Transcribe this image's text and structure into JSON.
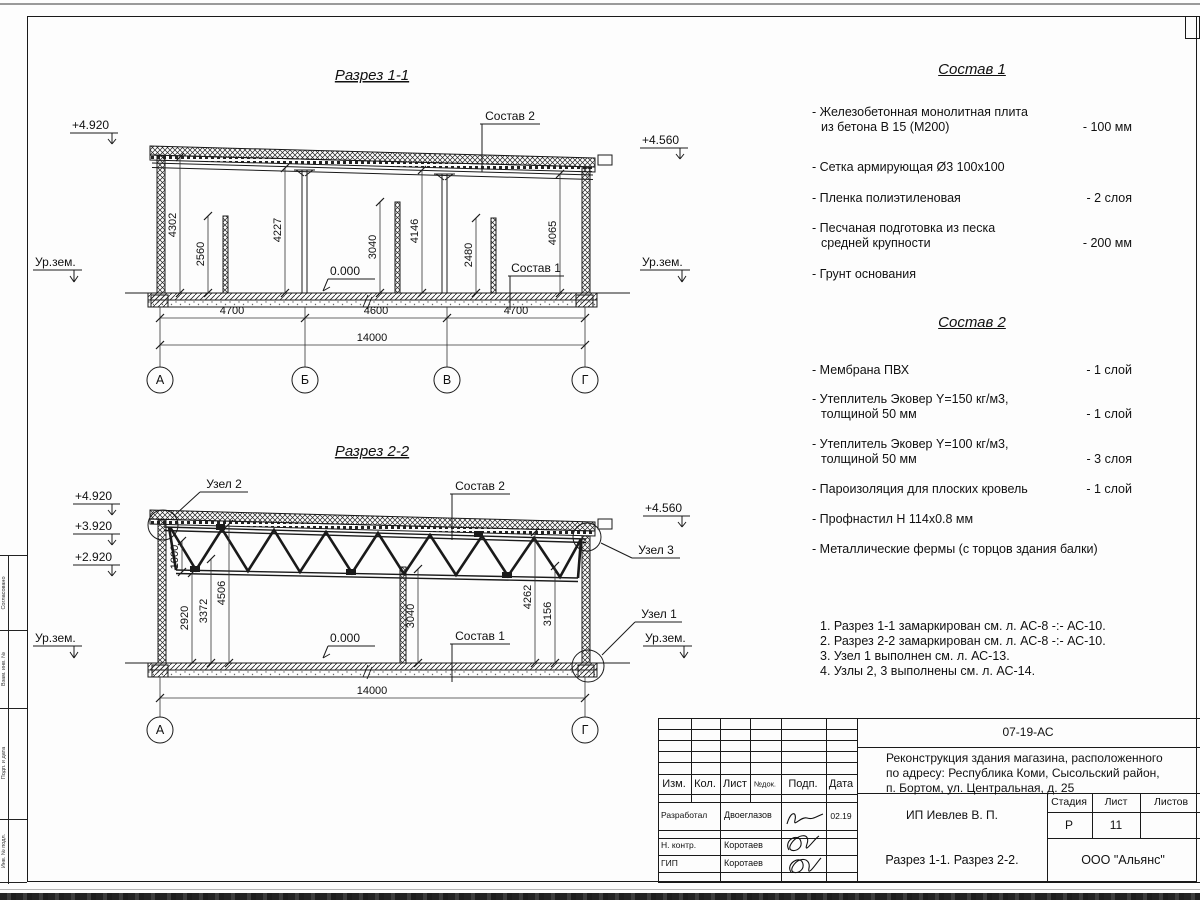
{
  "section1": {
    "title": "Разрез 1-1",
    "elev_left": "+4.920",
    "elev_right": "+4.560",
    "ground_left": "Ур.зем.",
    "ground_right": "Ур.зем.",
    "zero_label": "0.000",
    "label_sostav2": "Состав 2",
    "label_sostav1": "Состав 1",
    "dim_heights": [
      "4302",
      "2560",
      "4227",
      "3040",
      "4146",
      "2480",
      "4065"
    ],
    "dim_spans": [
      "4700",
      "4600",
      "4700"
    ],
    "dim_total": "14000",
    "axes": [
      "А",
      "Б",
      "В",
      "Г"
    ]
  },
  "section2": {
    "title": "Разрез 2-2",
    "elev_levels": [
      "+4.920",
      "+3.920",
      "+2.920"
    ],
    "elev_right": "+4.560",
    "ground_left": "Ур.зем.",
    "ground_right": "Ур.зем.",
    "zero_label": "0.000",
    "label_sostav2": "Состав 2",
    "label_sostav1": "Состав 1",
    "node2": "Узел 2",
    "node3": "Узел 3",
    "node1": "Узел 1",
    "dim_heights": [
      "1000",
      "2920",
      "3372",
      "4506",
      "3040",
      "4262",
      "3156"
    ],
    "dim_total": "14000",
    "axes": [
      "А",
      "Г"
    ]
  },
  "sostav1": {
    "title": "Состав 1",
    "items": [
      {
        "line1": "- Железобетонная  монолитная плита",
        "line2": "из бетона В 15 (М200)",
        "value": "- 100 мм"
      },
      {
        "line1": "- Сетка армирующая Ø3 100х100",
        "value": ""
      },
      {
        "line1": "- Пленка полиэтиленовая",
        "value": "-  2 слоя"
      },
      {
        "line1": "- Песчаная подготовка из песка",
        "line2": "средней крупности",
        "value": "- 200 мм"
      },
      {
        "line1": "- Грунт основания",
        "value": ""
      }
    ]
  },
  "sostav2": {
    "title": "Состав 2",
    "items": [
      {
        "line1": "- Мембрана ПВХ",
        "value": "- 1 слой"
      },
      {
        "line1": "- Утеплитель Эковер Y=150 кг/м3,",
        "line2": "толщиной 50 мм",
        "value": "- 1 слой"
      },
      {
        "line1": "- Утеплитель Эковер Y=100 кг/м3,",
        "line2": "толщиной 50 мм",
        "value": "- 3 слоя"
      },
      {
        "line1": "- Пароизоляция для плоских кровель",
        "value": "- 1 слой"
      },
      {
        "line1": "- Профнастил Н 114х0.8 мм",
        "value": ""
      },
      {
        "line1": "- Металлические фермы (с торцов здания балки)",
        "value": ""
      }
    ]
  },
  "notes": [
    "1. Разрез 1-1 замаркирован см. л. АС-8 -:- АС-10.",
    "2. Разрез 2-2 замаркирован см. л. АС-8 -:- АС-10.",
    "3. Узел 1 выполнен см. л. АС-13.",
    "4. Узлы 2, 3 выполнены см. л. АС-14."
  ],
  "titleblock": {
    "doc_code": "07-19-АС",
    "project_line1": "Реконструкция здания магазина, расположенного",
    "project_line2": "по адресу: Республика Коми, Сысольский район,",
    "project_line3": "п. Бортом, ул. Центральная, д. 25",
    "client": "ИП Иевлев В. П.",
    "sheet_title": "Разрез 1-1. Разрез 2-2.",
    "company": "ООО \"Альянс\"",
    "cols": {
      "izm": "Изм.",
      "kol": "Кол.",
      "list": "Лист",
      "ndok": "№док.",
      "podp": "Подп.",
      "data": "Дата"
    },
    "stage_header": {
      "stage": "Стадия",
      "sheet": "Лист",
      "sheets": "Листов"
    },
    "stage_value": "Р",
    "sheet_no": "11",
    "rows": [
      {
        "role": "Разработал",
        "name": "Двоеглазов",
        "date": "02.19"
      },
      {
        "role": "Н. контр.",
        "name": "Коротаев",
        "date": ""
      },
      {
        "role": "ГИП",
        "name": "Коротаев",
        "date": ""
      }
    ]
  },
  "side_stamp": {
    "labels": [
      "Согласовано",
      "Взам. инв. №",
      "Подп. и дата",
      "Инв. № подл."
    ]
  }
}
